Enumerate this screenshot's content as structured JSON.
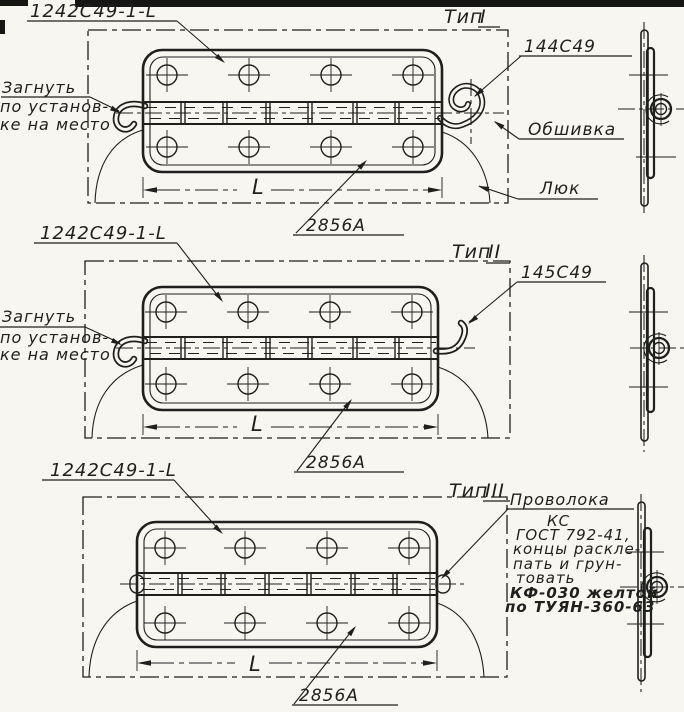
{
  "drawing": {
    "paper_color": "#f7f6f1",
    "ink_color": "#1f1f1e",
    "sections": [
      {
        "id": "type-1",
        "part_label": "1242С49-1-L",
        "type_prefix": "Тип",
        "type_numeral": "I",
        "end_label": "144С49",
        "skin_label": "Обшивка",
        "hatch_label": "Люк",
        "bend_note_lines": [
          "Загнуть",
          "по установ-",
          "ке на место"
        ],
        "dim_label": "L",
        "doc_label": "2856А"
      },
      {
        "id": "type-2",
        "part_label": "1242С49-1-L",
        "type_prefix": "Тип",
        "type_numeral": "II",
        "end_label": "145С49",
        "bend_note_lines": [
          "Загнуть",
          "по установ-",
          "ке на место"
        ],
        "dim_label": "L",
        "doc_label": "2856А"
      },
      {
        "id": "type-3",
        "part_label": "1242С49-1-L",
        "type_prefix": "Тип",
        "type_numeral": "III",
        "wire_note": {
          "title": "Проволока",
          "line1": "КС",
          "line2": "ГОСТ 792-41,",
          "line3": "концы раскле-",
          "line4": "пать и грун-",
          "line5": "товать",
          "bold1": "КФ-030 желтой",
          "bold2": "по ТУЯН-360-63"
        },
        "dim_label": "L",
        "doc_label": "2856А"
      }
    ]
  }
}
